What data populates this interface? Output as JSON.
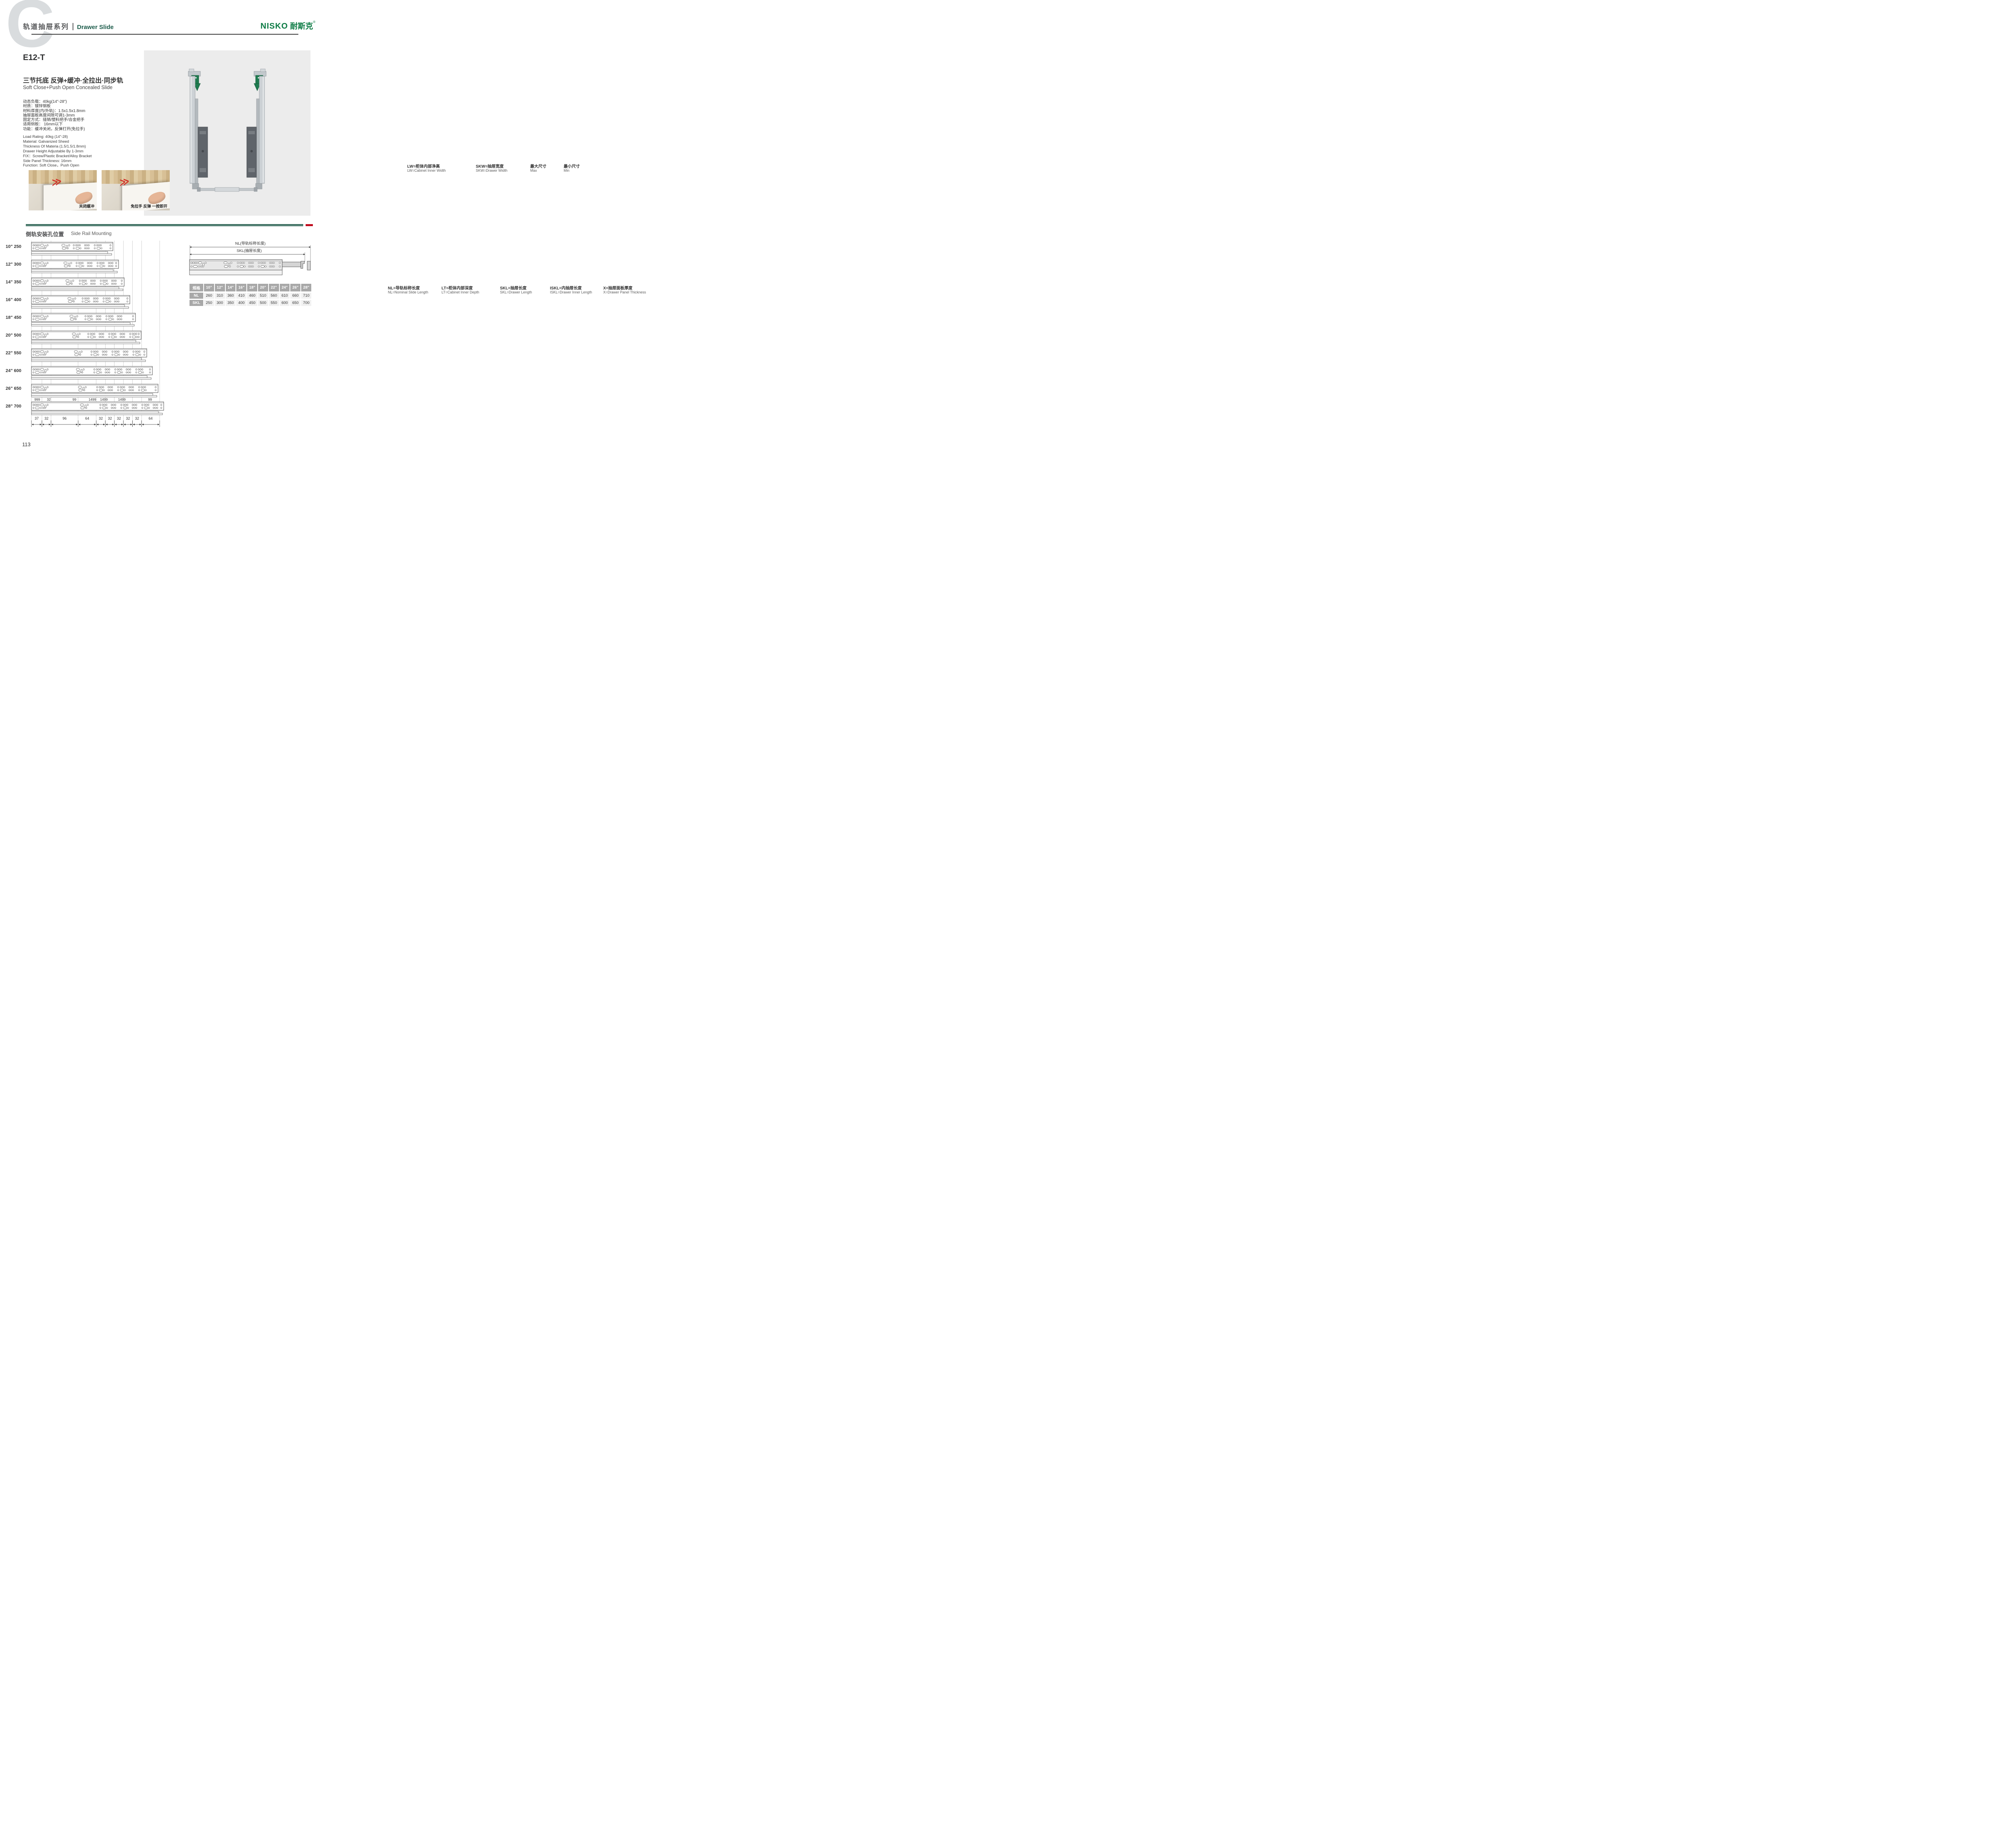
{
  "brand": {
    "logo_text": "NISKO",
    "logo_cn": "耐斯克",
    "reg": "®"
  },
  "header": {
    "series_cn": "轨道抽屉系列",
    "series_en": "Drawer Slide",
    "watermark": "C"
  },
  "left_page": {
    "page_number": "113",
    "product": {
      "model": "E12-T",
      "title_cn": "三节托底 反弹+缓冲·全拉出·同步轨",
      "title_en": "Soft Close+Push Open Concealed Slide",
      "specs_cn": [
        "动态负载：40kg(14\"-28\")",
        "材质：镀锌钢板",
        "材料厚度(内/外轨)：1.5x1.5x1.8mm",
        "抽屉面板高度间隙可调1-3mm",
        "固定方式：插销/塑料把手/合金把手",
        "适用侧板： 16mm以下",
        "功能：缓冲关闭，反弹打开(免拉手)"
      ],
      "specs_en": [
        "Load Rating: 40kg (14\"-28)",
        "Material: Galvanized Sheed",
        "Thickness Of Materia (1.5/1.5/1.8mm)",
        "Drawer Height Adjustable By 1-3mm",
        "FIX：Screw/Plastic Bracket/Alloy Bracket",
        "Side Panel Thickness: 16mm",
        "Function: Soft Close，Push Open"
      ],
      "arrow_icon": "≫",
      "photos": [
        {
          "caption": "关闭缓冲"
        },
        {
          "caption": "免拉手 反弹 一按即开"
        }
      ]
    },
    "side_rail": {
      "title_cn": "侧轨安装孔位置",
      "title_en": "Side Rail Mounting",
      "rows": [
        {
          "label": "10\" 250"
        },
        {
          "label": "12\" 300"
        },
        {
          "label": "14\" 350"
        },
        {
          "label": "16\" 400"
        },
        {
          "label": "18\" 450"
        },
        {
          "label": "20\" 500"
        },
        {
          "label": "22\" 550"
        },
        {
          "label": "24\" 600"
        },
        {
          "label": "26\" 650"
        },
        {
          "label": "28\" 700"
        }
      ],
      "top_dims": [
        "999",
        "32",
        "99",
        "1499",
        "1499",
        "1499",
        "99"
      ],
      "bottom_dims": [
        37,
        32,
        96,
        64,
        32,
        32,
        32,
        32,
        32,
        64
      ]
    },
    "slide_diagram": {
      "nl": "NL(导轨标称长度)",
      "skl": "SKL(抽屉长度)"
    },
    "table": {
      "header": [
        "规格",
        "10\"",
        "12\"",
        "14\"",
        "16\"",
        "18\"",
        "20\"",
        "22\"",
        "24\"",
        "26\"",
        "28\""
      ],
      "rows": [
        {
          "label": "NL",
          "values": [
            "260",
            "310",
            "360",
            "410",
            "460",
            "510",
            "560",
            "610",
            "660",
            "710"
          ]
        },
        {
          "label": "SKL",
          "values": [
            "250",
            "300",
            "350",
            "400",
            "450",
            "500",
            "550",
            "600",
            "650",
            "700"
          ]
        }
      ]
    }
  },
  "right_page": {
    "page_number": "114",
    "section_title_cn": "安装指南-柜体尺寸设计",
    "section_title_en": "Installtion Cabinet Size Dimension",
    "width_box": {
      "title": "宽度尺寸：",
      "lw": "LW",
      "skw": "SKW=LW-42",
      "min7": "(Min)7",
      "min3": "(Min)3",
      "min275": "(Min)27.5",
      "max16": "(Max)16",
      "d12": "12",
      "d10": "10",
      "d37": "37",
      "d21": "21",
      "legend": [
        {
          "cn": "LW=柜体内部净高",
          "en": "LW=Cabinet Inner Width"
        },
        {
          "cn": "SKW=抽屉宽度",
          "en": "SKW=Drawer  Width"
        },
        {
          "cn": "最大尺寸",
          "en": "Max"
        },
        {
          "cn": "最小尺寸",
          "en": "Min"
        }
      ]
    },
    "depth_box": {
      "title": "深度尺寸：",
      "min_gap": "最小间隙(Min gap)4mm",
      "standard": {
        "cn": "抽屉外盖安装",
        "en": "Standard drawer",
        "nl": "NL",
        "d37": "37",
        "skl": "SKL=NL-10",
        "lt": "(Min) LT=NL+10"
      },
      "builtin": {
        "cn": "抽屉内置安装",
        "en": "Built-in drawer",
        "x": "X",
        "nl": "NL",
        "iskl": "ISKL=SKL+X",
        "lt": "(Min) LT=NL+X+10"
      },
      "edge": {
        "cn": "柜体前沿",
        "en": "Cabinet Edge"
      },
      "legend": [
        {
          "cn": "NL=导轨标称长度",
          "en": "NL=Nominal Slide Length"
        },
        {
          "cn": "LT=柜体内部深度",
          "en": "LT=Cabinet Inner Depth"
        },
        {
          "cn": "SKL=抽屉长度",
          "en": "SKL=Drawer Length"
        },
        {
          "cn": "ISKL=内抽屉长度",
          "en": "ISKL=Drawer Inner Length"
        },
        {
          "cn": "X=抽屉面板厚度",
          "en": "X=Drawer Panel Thickness"
        }
      ]
    },
    "bottom_box": {
      "title": "底部尺寸：",
      "d75": "75",
      "d85": "85",
      "d11": "11",
      "d7": "7",
      "hole_note": "Φ6 钻孔深度Min11",
      "skl_note": "抽屉长度SKL=导轨标称长度NL-10"
    }
  },
  "colors": {
    "logo_green": "#0c7b44",
    "title_green": "#1d5c4b",
    "bar_green": "#0a4a38",
    "bar_red": "#c00c1e",
    "watermark_gray": "#d9dcde",
    "wood_tan": "#f3e8c9",
    "slide_orange": "#f6a742",
    "table_gray": "#a8a8a8",
    "cell_gray": "#f1f1f1"
  }
}
